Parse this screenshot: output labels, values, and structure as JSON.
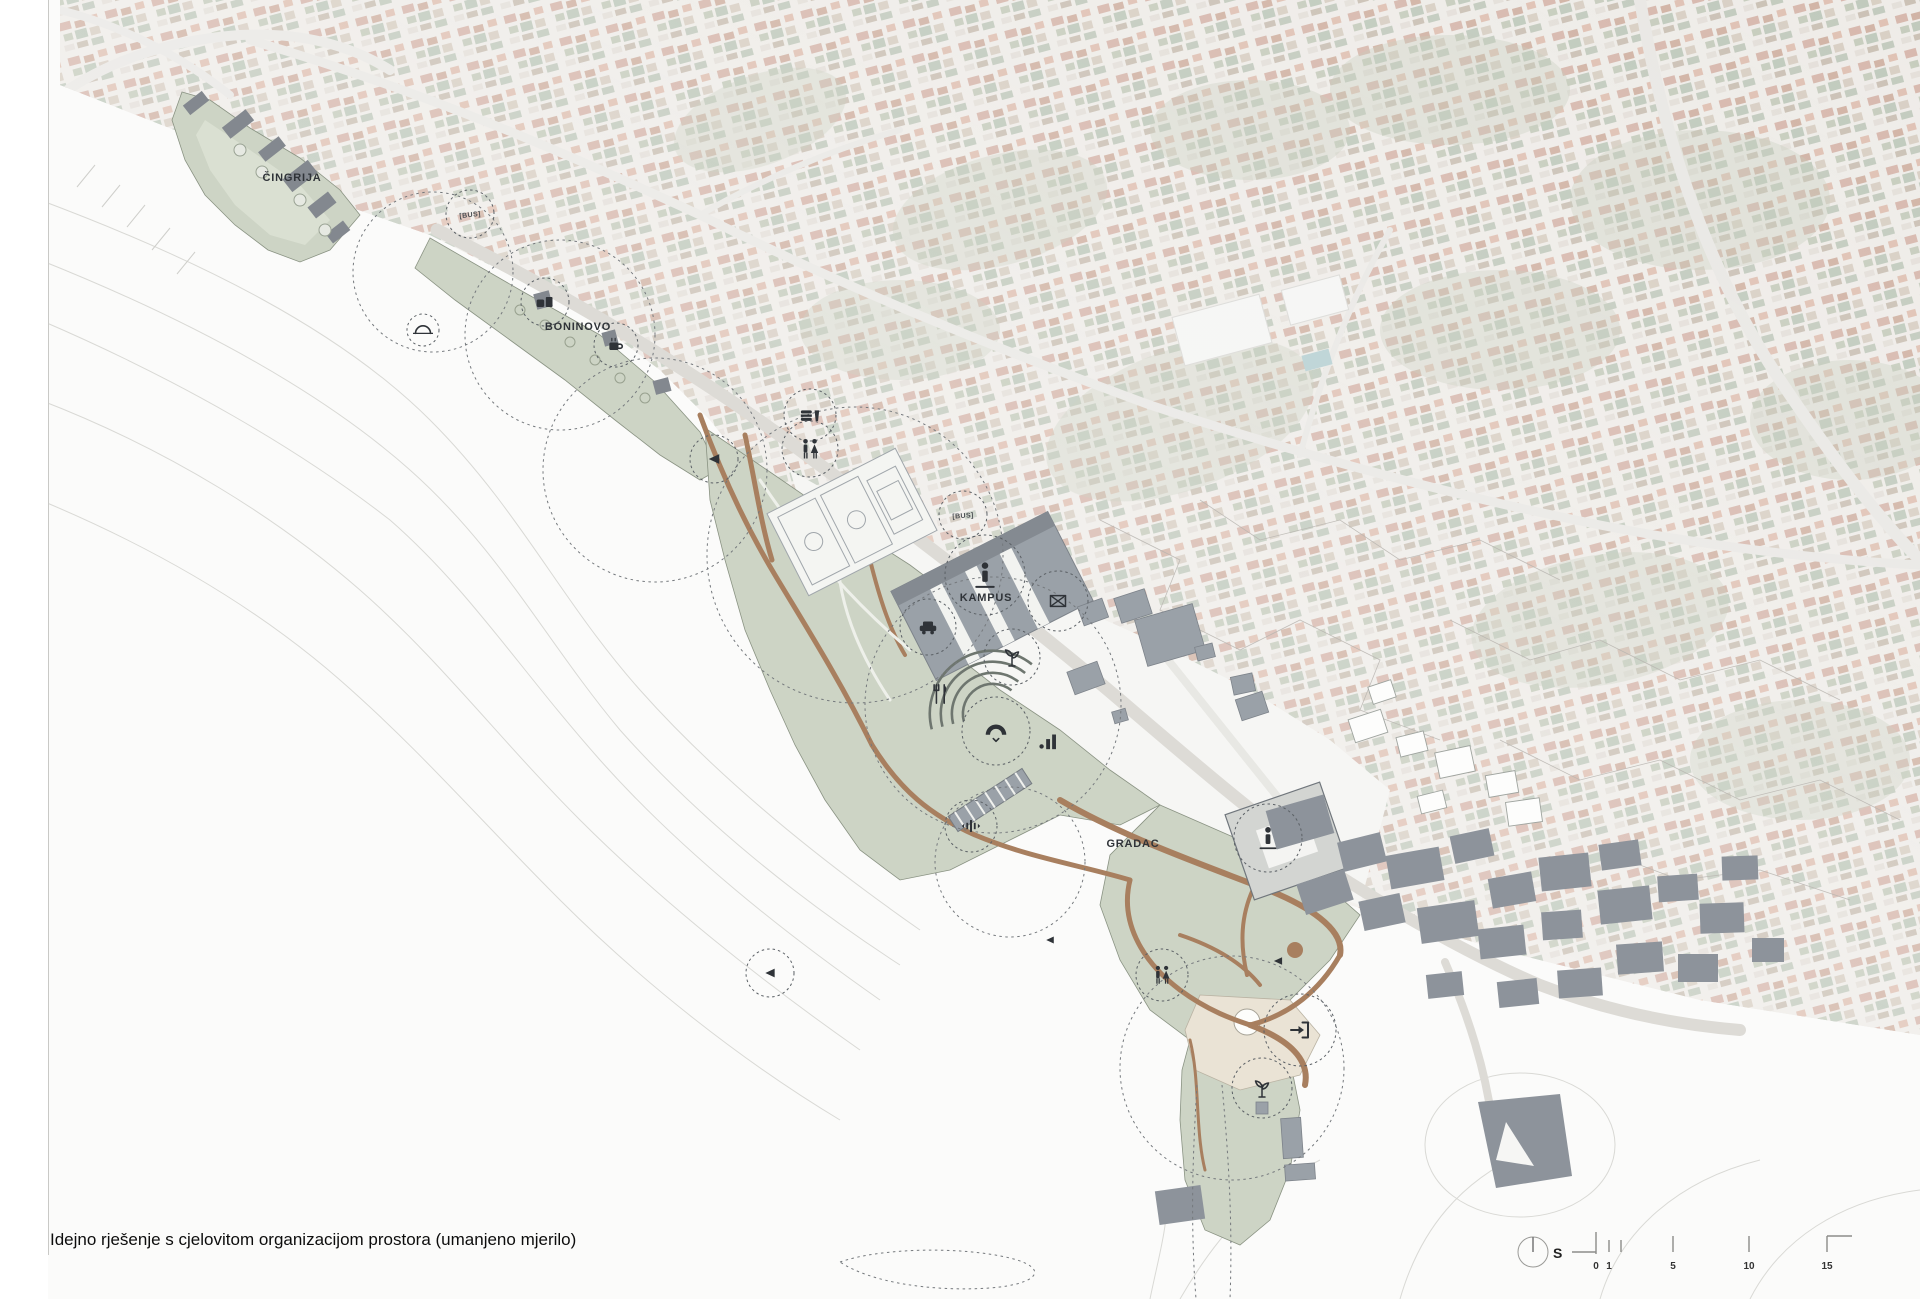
{
  "page": {
    "caption": "Idejno rješenje s cjelovitom organizacijom prostora (umanjeno mjerilo)"
  },
  "legend": {
    "north_label": "S",
    "scale_ticks": [
      {
        "label": "0",
        "x": 1596
      },
      {
        "label": "1",
        "x": 1609
      },
      {
        "label": "5",
        "x": 1673
      },
      {
        "label": "10",
        "x": 1749
      },
      {
        "label": "15",
        "x": 1827
      }
    ]
  },
  "map": {
    "region_labels": [
      {
        "id": "cingrija",
        "text": "ČINGRIJA",
        "x": 292,
        "y": 181
      },
      {
        "id": "boninovo",
        "text": "BONINOVO",
        "x": 578,
        "y": 330
      },
      {
        "id": "kampus",
        "text": "KAMPUS",
        "x": 986,
        "y": 601
      },
      {
        "id": "gradac",
        "text": "GRADAC",
        "x": 1133,
        "y": 847
      }
    ],
    "bus_stops": [
      {
        "text": "[BUS]",
        "x": 470,
        "y": 214,
        "rot": -6
      },
      {
        "text": "[BUS]",
        "x": 963,
        "y": 515,
        "rot": -4
      }
    ],
    "program_markers": [
      {
        "icon": "bridge",
        "x": 423,
        "y": 330,
        "r": 16,
        "size": 20
      },
      {
        "icon": "kiosk",
        "x": 545,
        "y": 302,
        "r": 24,
        "size": 20
      },
      {
        "icon": "coffee",
        "x": 616,
        "y": 345,
        "r": 22,
        "size": 20
      },
      {
        "icon": "food",
        "x": 810,
        "y": 415,
        "r": 26,
        "size": 22
      },
      {
        "icon": "wc",
        "x": 810,
        "y": 449,
        "r": 28,
        "size": 24
      },
      {
        "icon": "viewpoint",
        "x": 714,
        "y": 459,
        "r": 24,
        "size": 18
      },
      {
        "icon": "person",
        "x": 985,
        "y": 575,
        "r": 40,
        "size": 30
      },
      {
        "icon": "mail",
        "x": 1058,
        "y": 601,
        "r": 30,
        "size": 20
      },
      {
        "icon": "car",
        "x": 928,
        "y": 627,
        "r": 28,
        "size": 22
      },
      {
        "icon": "sprout",
        "x": 1012,
        "y": 657,
        "r": 28,
        "size": 24
      },
      {
        "icon": "restaurant",
        "x": 941,
        "y": 694,
        "r": 0,
        "size": 22
      },
      {
        "icon": "bandshell",
        "x": 996,
        "y": 731,
        "r": 34,
        "size": 26
      },
      {
        "icon": "chart",
        "x": 1048,
        "y": 740,
        "r": 0,
        "size": 22
      },
      {
        "icon": "soundwave",
        "x": 971,
        "y": 826,
        "r": 26,
        "size": 22
      },
      {
        "icon": "viewpoint",
        "x": 770,
        "y": 973,
        "r": 24,
        "size": 16
      },
      {
        "icon": "viewpoint",
        "x": 1278,
        "y": 961,
        "r": 0,
        "size": 14
      },
      {
        "icon": "viewpoint",
        "x": 1050,
        "y": 940,
        "r": 0,
        "size": 13
      },
      {
        "icon": "wc",
        "x": 1162,
        "y": 975,
        "r": 26,
        "size": 22
      },
      {
        "icon": "person",
        "x": 1268,
        "y": 838,
        "r": 34,
        "size": 26
      },
      {
        "icon": "entrance",
        "x": 1300,
        "y": 1030,
        "r": 36,
        "size": 24
      },
      {
        "icon": "sprout",
        "x": 1262,
        "y": 1088,
        "r": 30,
        "size": 24
      }
    ]
  },
  "colors": {
    "ink": "#2f3338",
    "design-green": "#cdd4c5",
    "design-green-light": "#dde2d4",
    "path-brown": "#a87f5f",
    "building-gray": "#9aa1a8",
    "building-dark": "#83888f",
    "footprint": "#8d939b",
    "plaza": "#eae3d5",
    "contour": "#d9d9d5",
    "aerial-base": "#e6e2dc",
    "roof": "#c29383",
    "vegetation": "#a3b095",
    "road": "#dddbd6",
    "pool": "#8fb6ba",
    "paper": "#fbfbfa"
  }
}
